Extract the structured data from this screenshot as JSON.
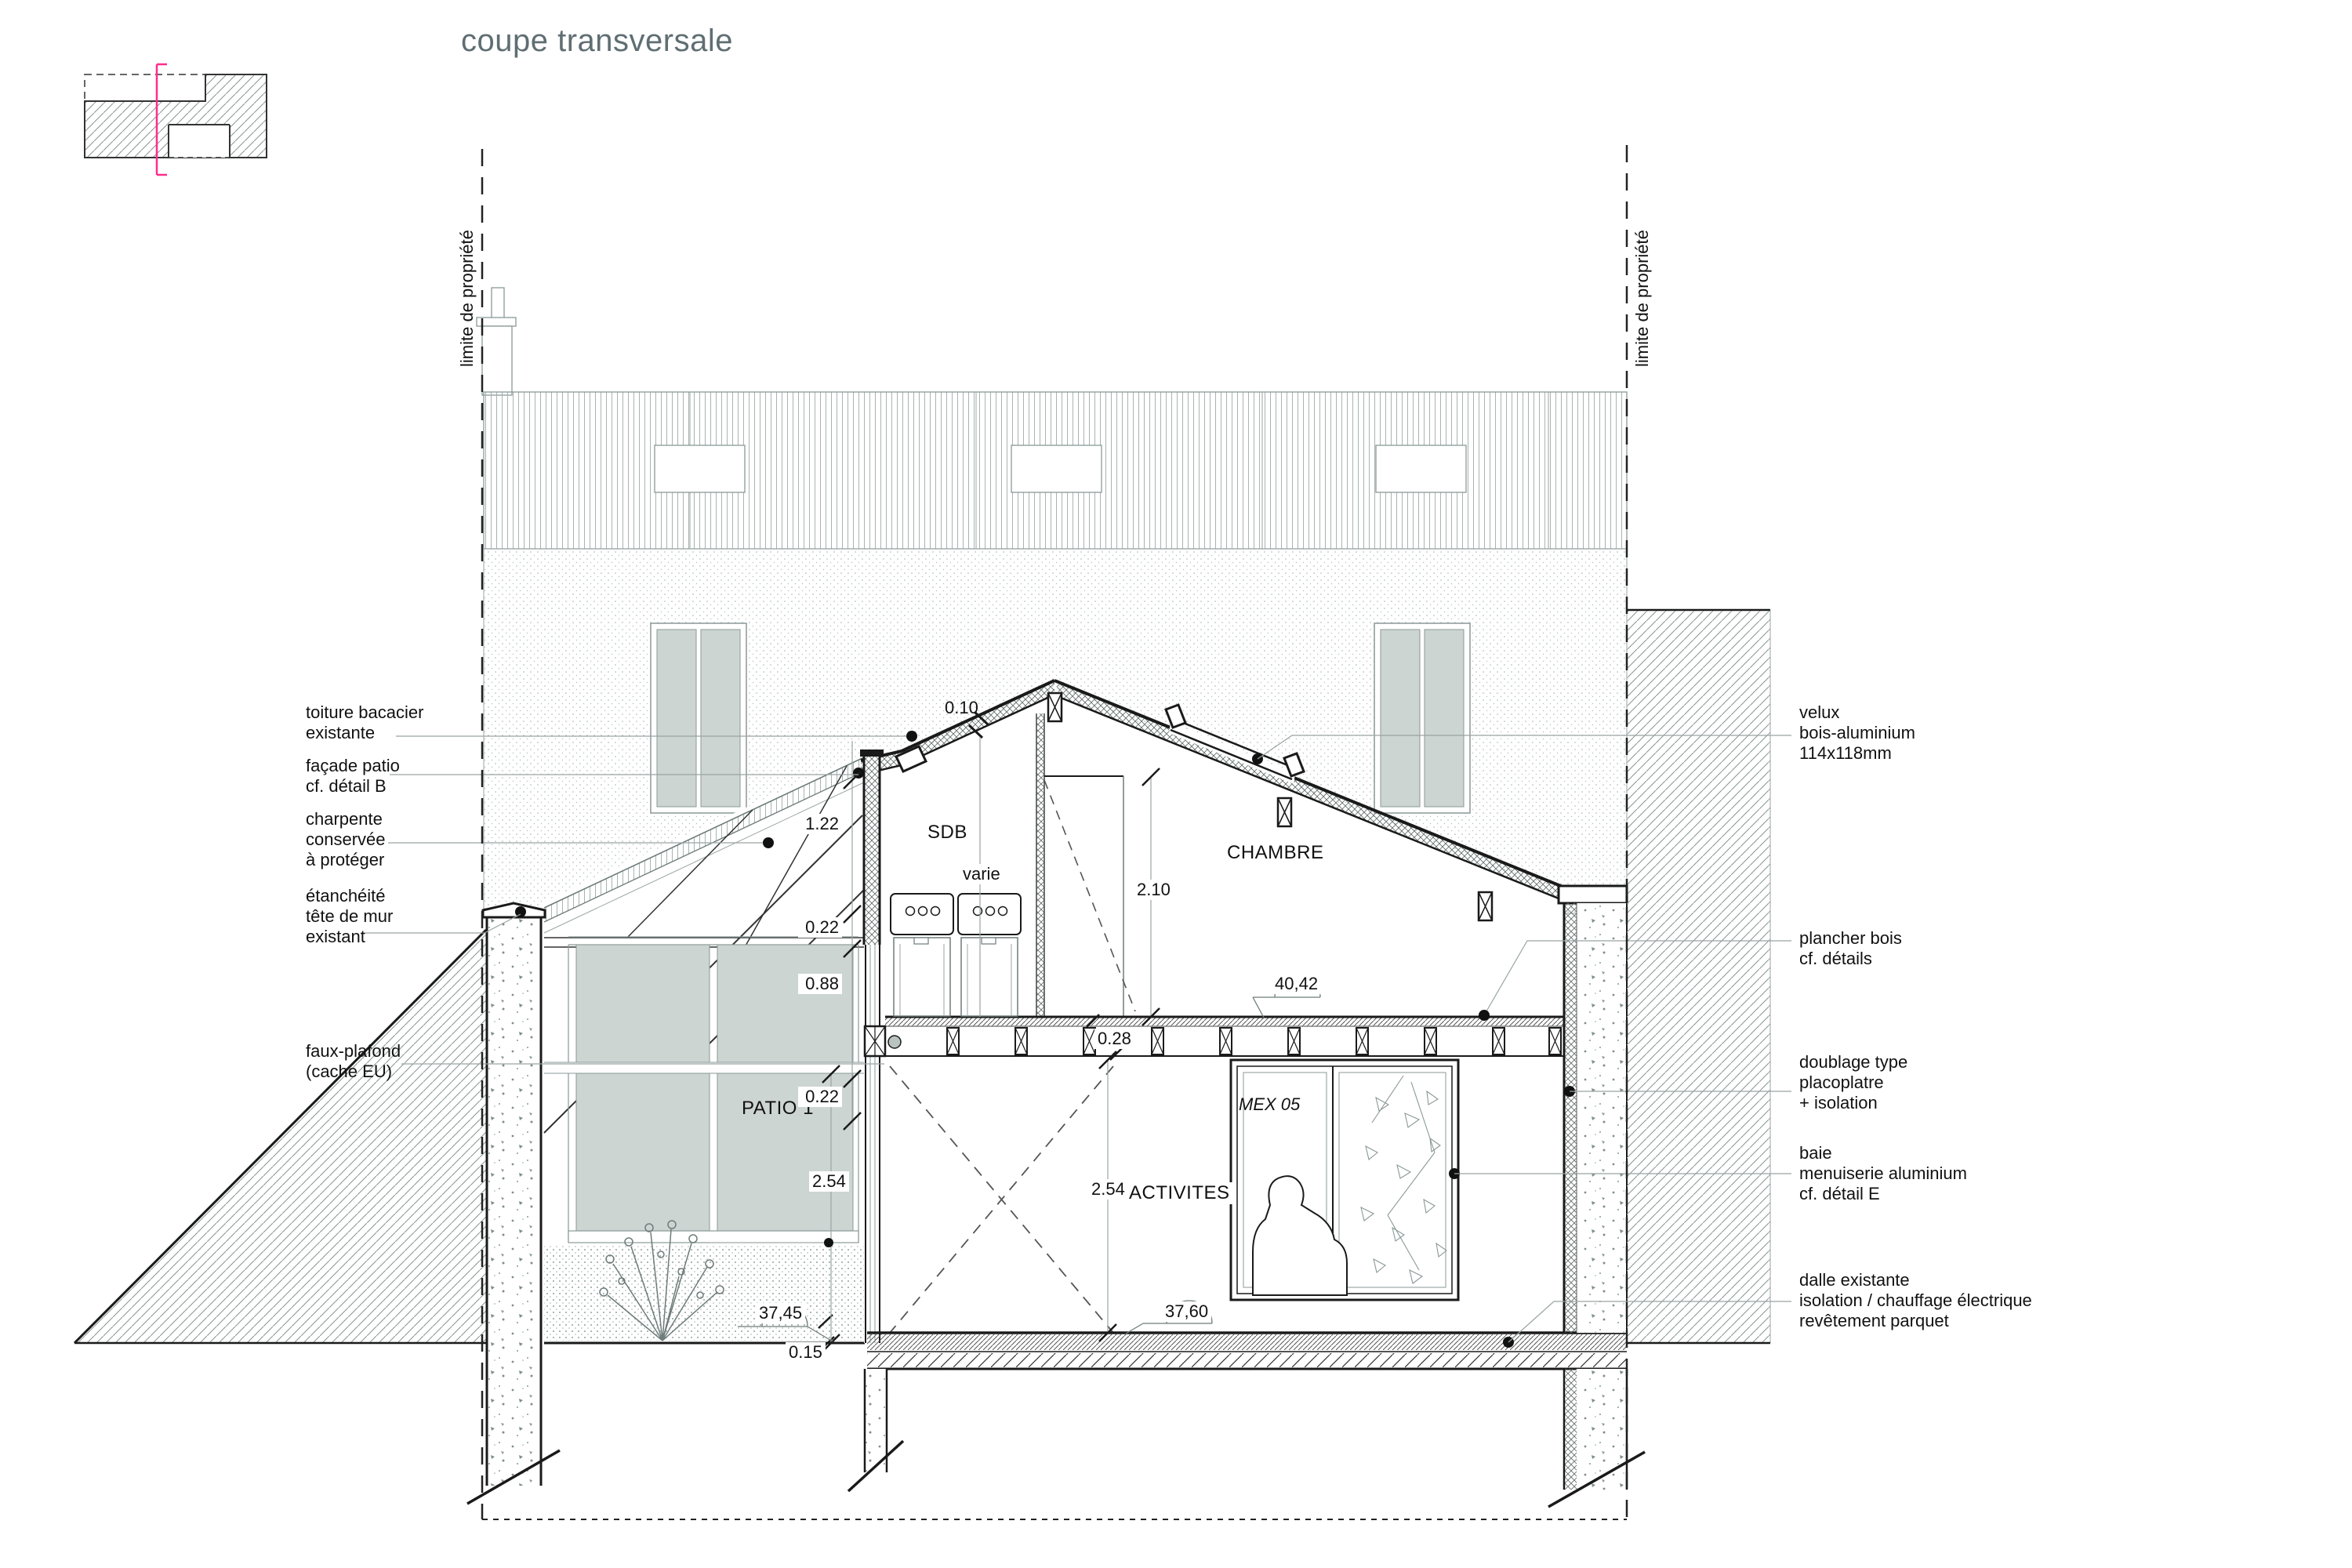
{
  "title": "coupe transversale",
  "property_limit": "limite de propriété",
  "rooms": {
    "sdb": "SDB",
    "chambre": "CHAMBRE",
    "patio": "PATIO 1",
    "activites": "ACTIVITES"
  },
  "window_tag": "MEX 05",
  "annotations": {
    "left": [
      {
        "id": "toiture",
        "lines": [
          "toiture bacacier",
          "existante"
        ]
      },
      {
        "id": "facade-patio",
        "lines": [
          "façade patio",
          "cf. détail B"
        ]
      },
      {
        "id": "charpente",
        "lines": [
          "charpente",
          "conservée",
          "à protéger"
        ]
      },
      {
        "id": "etancheite",
        "lines": [
          "étanchéité",
          "tête de mur",
          "existant"
        ]
      },
      {
        "id": "faux-plafond",
        "lines": [
          "faux-plafond",
          "(cache EU)"
        ]
      }
    ],
    "right": [
      {
        "id": "velux",
        "lines": [
          "velux",
          "bois-aluminium",
          "114x118mm"
        ]
      },
      {
        "id": "plancher",
        "lines": [
          "plancher bois",
          "cf. détails"
        ]
      },
      {
        "id": "doublage",
        "lines": [
          "doublage type",
          "placoplatre",
          "+ isolation"
        ]
      },
      {
        "id": "baie",
        "lines": [
          "baie",
          "menuiserie aluminium",
          "cf. détail E"
        ]
      },
      {
        "id": "dalle",
        "lines": [
          "dalle existante",
          "isolation / chauffage électrique",
          "revêtement parquet"
        ]
      }
    ]
  },
  "dimensions": {
    "roof_thickness": "0.10",
    "h122": "1.22",
    "h022a": "0.22",
    "h088": "0.88",
    "h022b": "0.22",
    "w028": "0.28",
    "varie": "varie",
    "h210": "2.10",
    "h254_patio": "2.54",
    "h254_activites": "2.54",
    "step": "0.15"
  },
  "levels": {
    "patio": "37,45",
    "ground_floor": "37,60",
    "upper_floor": "40,42"
  },
  "colors": {
    "ink": "#1a1a1a",
    "thin_gray": "#98a5a2",
    "leader_gray": "#9aa5a3",
    "level_gray": "#6e7c7a",
    "glass": "#cdd5d2",
    "title_gray": "#5f6e72",
    "section_cut_pink": "#ff2d8d"
  }
}
